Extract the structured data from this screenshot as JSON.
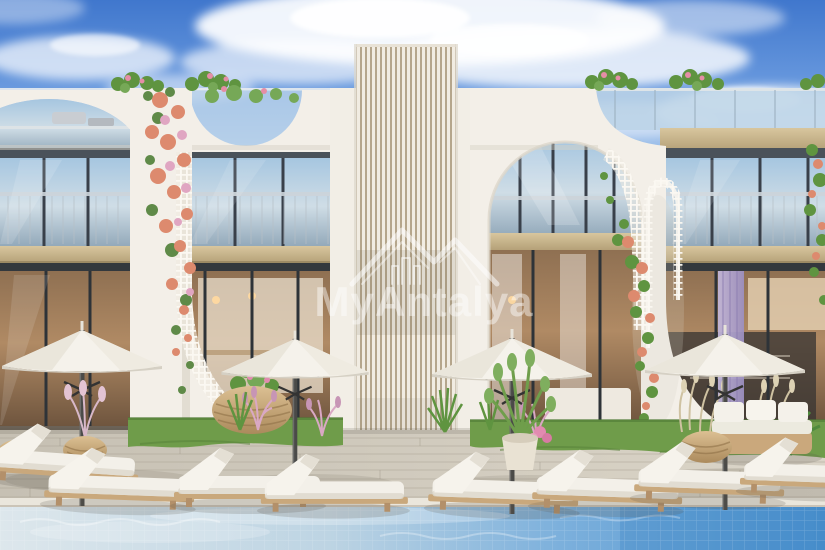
{
  "watermark": {
    "brand": "MyAntalya",
    "logo": "mountain-peaks-with-building"
  },
  "scene": {
    "subject": "modern white apartment building with arched facade, pool deck, umbrellas and sun loungers",
    "counts": {
      "umbrellas": 4,
      "sun_loungers": 8,
      "floors_visible": 2
    }
  },
  "palette": {
    "sky_blue": "#4077cd",
    "cloud_white": "#ffffff",
    "facade_white": "#f3efe8",
    "louver_beige": "#b5a68c",
    "glass_sky_reflection": "#a6c6e0",
    "window_frame_dark": "#3c434b",
    "slab_tan": "#c9b48c",
    "interior_warm": "#a9845f",
    "curtain_purple": "#a99bc8",
    "deck_gray": "#d0cabd",
    "grass_green": "#6f9c4a",
    "pool_blue": "#4a90cd",
    "umbrella_white": "#f5f2eb",
    "lounger_wood": "#c9a87c",
    "flower_coral": "#dd8a6e",
    "flower_pink": "#e0a6c2",
    "watermark_white": "#ffffff"
  }
}
